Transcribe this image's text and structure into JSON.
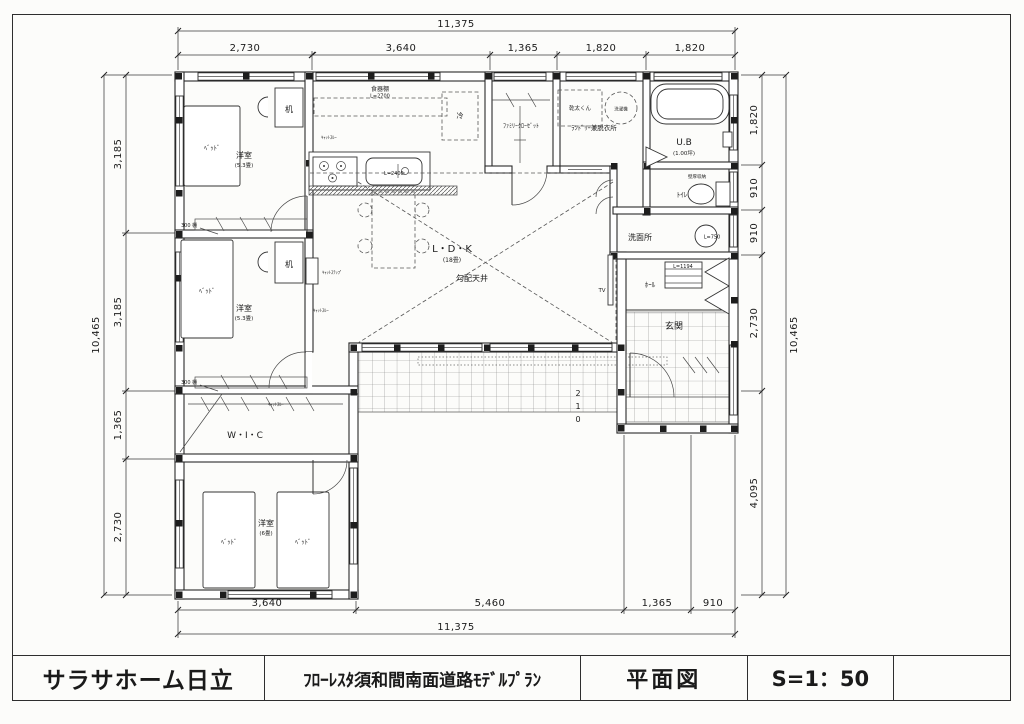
{
  "dims": {
    "top": {
      "total": "11,375",
      "segments": [
        "2,730",
        "3,640",
        "1,365",
        "1,820",
        "1,820"
      ]
    },
    "bottom": {
      "total": "11,375",
      "segments": [
        "3,640",
        "5,460",
        "1,365",
        "910"
      ]
    },
    "left": {
      "total": "10,465",
      "segments": [
        "3,185",
        "3,185",
        "1,365",
        "2,730"
      ]
    },
    "right": {
      "total": "10,465",
      "segments": [
        "1,820",
        "910",
        "910",
        "2,730",
        "4,095"
      ]
    }
  },
  "rooms": {
    "bedroom1": {
      "name": "洋室",
      "size": "(5.3畳)"
    },
    "bedroom2": {
      "name": "洋室",
      "size": "(5.3畳)"
    },
    "bedroom3": {
      "name": "洋室",
      "size": "(6畳)"
    },
    "ldk": {
      "name": "L・D・K",
      "size": "(18畳)",
      "ceiling": "勾配天井"
    },
    "wic": {
      "name": "W・I・C"
    },
    "family_closet": {
      "name": "ﾌｧﾐﾘｰｸﾛｰｾﾞｯﾄ"
    },
    "laundry": {
      "name": "ﾗﾝﾄﾞﾘｰ兼脱衣所"
    },
    "bath": {
      "name": "U.B",
      "size": "(1.00坪)"
    },
    "toilet": {
      "name": "ﾄｲﾚ"
    },
    "washroom": {
      "name": "洗面所"
    },
    "hall": {
      "name": "ﾎｰﾙ"
    },
    "genkan": {
      "name": "玄関"
    }
  },
  "fixtures": {
    "bed": "ﾍﾞｯﾄﾞ",
    "desk": "机",
    "fridge": "冷",
    "cupboard": "食器棚",
    "cupboard_length": "L=2700",
    "kitchen_length": "L=2400",
    "dryer": "乾太くん",
    "washer": "洗濯機",
    "tv": "TV",
    "wall_storage": "壁厚収納",
    "vanity_length": "L=750",
    "shoe_length": "L=1194",
    "cat_step": "ｷｬｯﾄｽﾃｯﾌﾟ",
    "cat_through": "ｷｬｯﾄｽﾙｰ",
    "shelf_note": "300 棚",
    "steps": [
      "2",
      "1",
      "0"
    ]
  },
  "title_block": {
    "company": "サラサホーム日立",
    "project": "ﾌﾛｰﾚｽﾀ須和間南面道路ﾓﾃﾞﾙﾌﾟﾗﾝ",
    "drawing_name": "平面図",
    "scale": "S=1：50"
  }
}
